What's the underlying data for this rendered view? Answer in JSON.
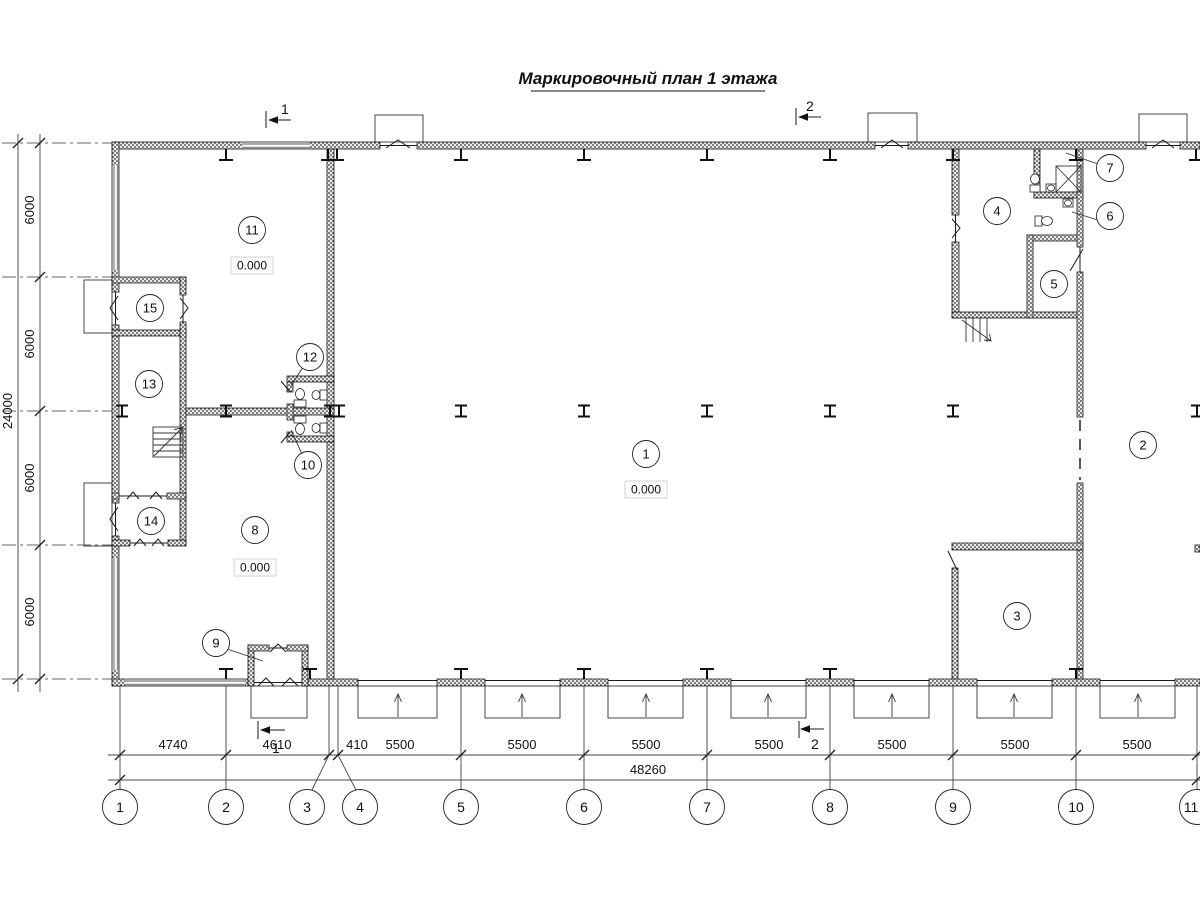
{
  "title": "Маркировочный план 1 этажа",
  "dimensions": {
    "left": {
      "segments": [
        "6000",
        "6000",
        "6000",
        "6000"
      ],
      "total": "24000"
    },
    "bottom": {
      "segments": [
        "4740",
        "4610",
        "410",
        "5500",
        "5500",
        "5500",
        "5500",
        "5500",
        "5500",
        "5500"
      ],
      "total": "48260"
    }
  },
  "grid_axes": {
    "labels": [
      "1",
      "2",
      "3",
      "4",
      "5",
      "6",
      "7",
      "8",
      "9",
      "10",
      "11"
    ]
  },
  "sections": {
    "top_1": "1",
    "top_2": "2",
    "bottom_1": "1",
    "bottom_2": "2"
  },
  "rooms": [
    {
      "num": "1",
      "level": "0.000"
    },
    {
      "num": "2"
    },
    {
      "num": "3"
    },
    {
      "num": "4"
    },
    {
      "num": "5"
    },
    {
      "num": "6"
    },
    {
      "num": "7"
    },
    {
      "num": "8",
      "level": "0.000"
    },
    {
      "num": "9"
    },
    {
      "num": "10"
    },
    {
      "num": "11",
      "level": "0.000"
    },
    {
      "num": "12"
    },
    {
      "num": "13"
    },
    {
      "num": "14"
    },
    {
      "num": "15"
    }
  ]
}
